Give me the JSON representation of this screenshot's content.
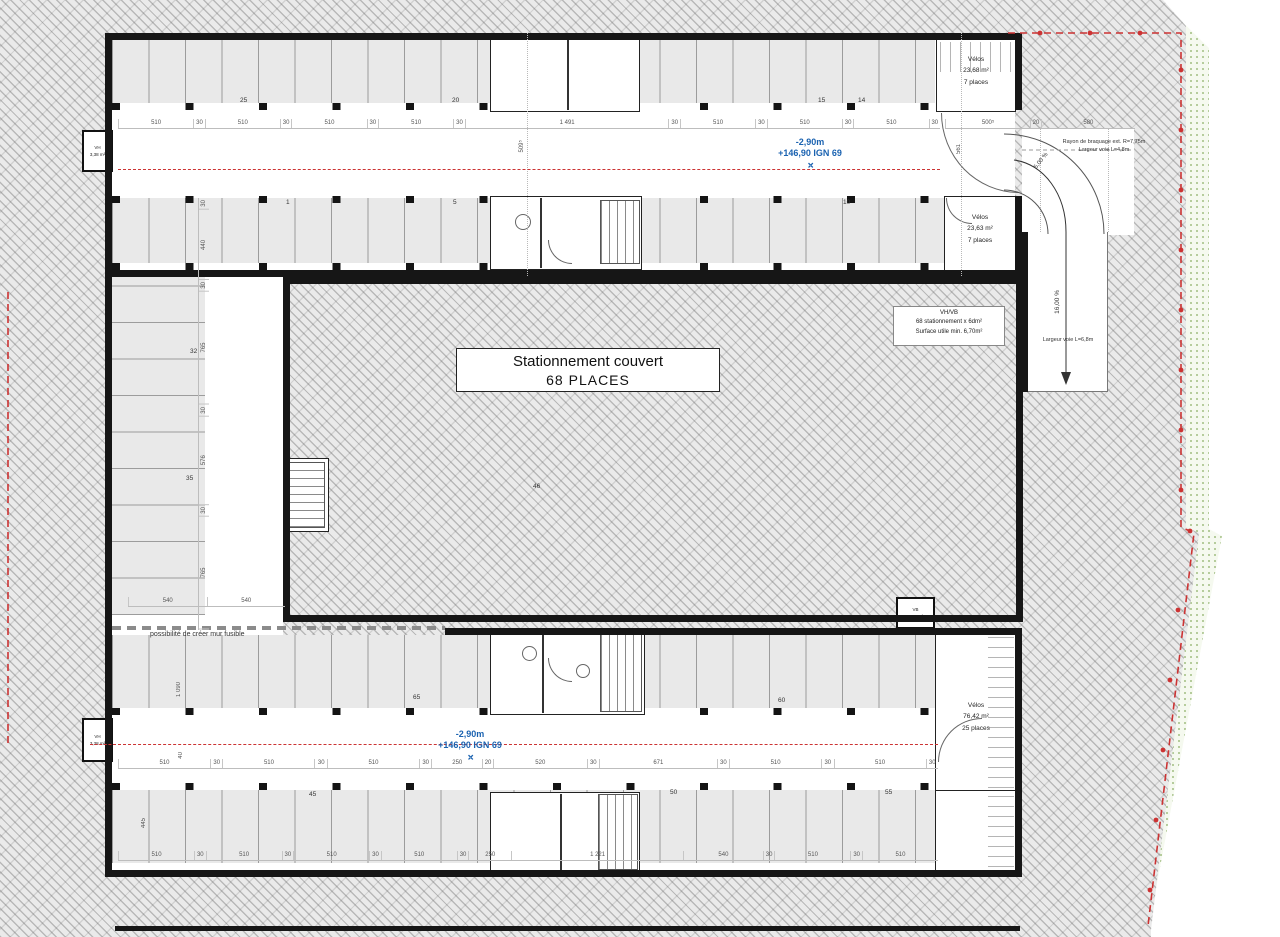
{
  "colors": {
    "accent_blue": "#1a62b0",
    "boundary_red": "#cc3333",
    "wall_black": "#161616",
    "stall_gray": "#e9e9e9",
    "green_dot": "#a9c48c"
  },
  "plan": {
    "title": {
      "line1": "Stationnement couvert",
      "line2": "68 PLACES"
    },
    "level_top": {
      "line1": "-2,90m",
      "line2": "+146,90 IGN 69"
    },
    "level_bottom": {
      "line1": "-2,90m",
      "line2": "+146,90 IGN 69"
    },
    "marker_glyph": "✛"
  },
  "rooms": {
    "velos_top": {
      "name": "Vélos",
      "area": "23,68 m²",
      "places": "7 places"
    },
    "velos_mid": {
      "name": "Vélos",
      "area": "23,63 m²",
      "places": "7 places"
    },
    "velos_bottom": {
      "name": "Vélos",
      "area": "76,42 m²",
      "places": "25 places"
    },
    "vent_left_top": {
      "name": "VH",
      "area": "3,38 m²"
    },
    "vent_left_bottom": {
      "name": "VH",
      "area": "3,38 m²"
    },
    "vent_bottom_mid": {
      "name": "VB",
      "area": "3,38 m²"
    }
  },
  "annotations": {
    "vhvb": {
      "line1": "VH/VB",
      "line2": "68 stationnement x 6dm²",
      "line3": "Surface utile min. 6,70m²"
    },
    "turning": {
      "line1": "Rayon de braquage ext. R=7,75m",
      "line2": "Largeur voie L=4,8m"
    },
    "slope_upper": "5,00 %",
    "slope_lower": "16,00 %",
    "ramp_width": "Largeur voie L=6,8m",
    "fusible": "possibilité de créer mur fusible"
  },
  "dimensions": {
    "top_chain": [
      "510",
      "30",
      "510",
      "30",
      "510",
      "30",
      "510",
      "30",
      "1 491",
      "30",
      "510",
      "30",
      "510",
      "30",
      "510",
      "30"
    ],
    "top_right_chain": [
      "500⁵",
      "20",
      "580"
    ],
    "bottom_aisle_chain": [
      "510",
      "30",
      "510",
      "30",
      "510",
      "30",
      "250",
      "20",
      "520",
      "30",
      "671",
      "30",
      "510",
      "30",
      "510",
      "30"
    ],
    "bottom_chain": [
      "510",
      "30",
      "510",
      "30",
      "510",
      "30",
      "510",
      "30",
      "250",
      "1 221",
      "540",
      "30",
      "510",
      "30",
      "510"
    ],
    "left_chain": [
      "30",
      "440",
      "30",
      "765",
      "30",
      "576",
      "30",
      "765"
    ],
    "pair_540": [
      "540",
      "540"
    ],
    "vert_top_center": "509⁵",
    "vert_top_right": "561",
    "vert_left_bottom_a": "1 090",
    "vert_left_bottom_b": "40",
    "vert_left_bottom_c": "445"
  },
  "stall_numbers": {
    "top_upper": [
      "25",
      "20",
      "15",
      "14"
    ],
    "top_lower": [
      "1",
      "5",
      "10"
    ],
    "left": [
      "32",
      "35"
    ],
    "center": "46",
    "bottom_upper": [
      "65",
      "60"
    ],
    "bottom_lower": [
      "45",
      "50",
      "55"
    ]
  }
}
